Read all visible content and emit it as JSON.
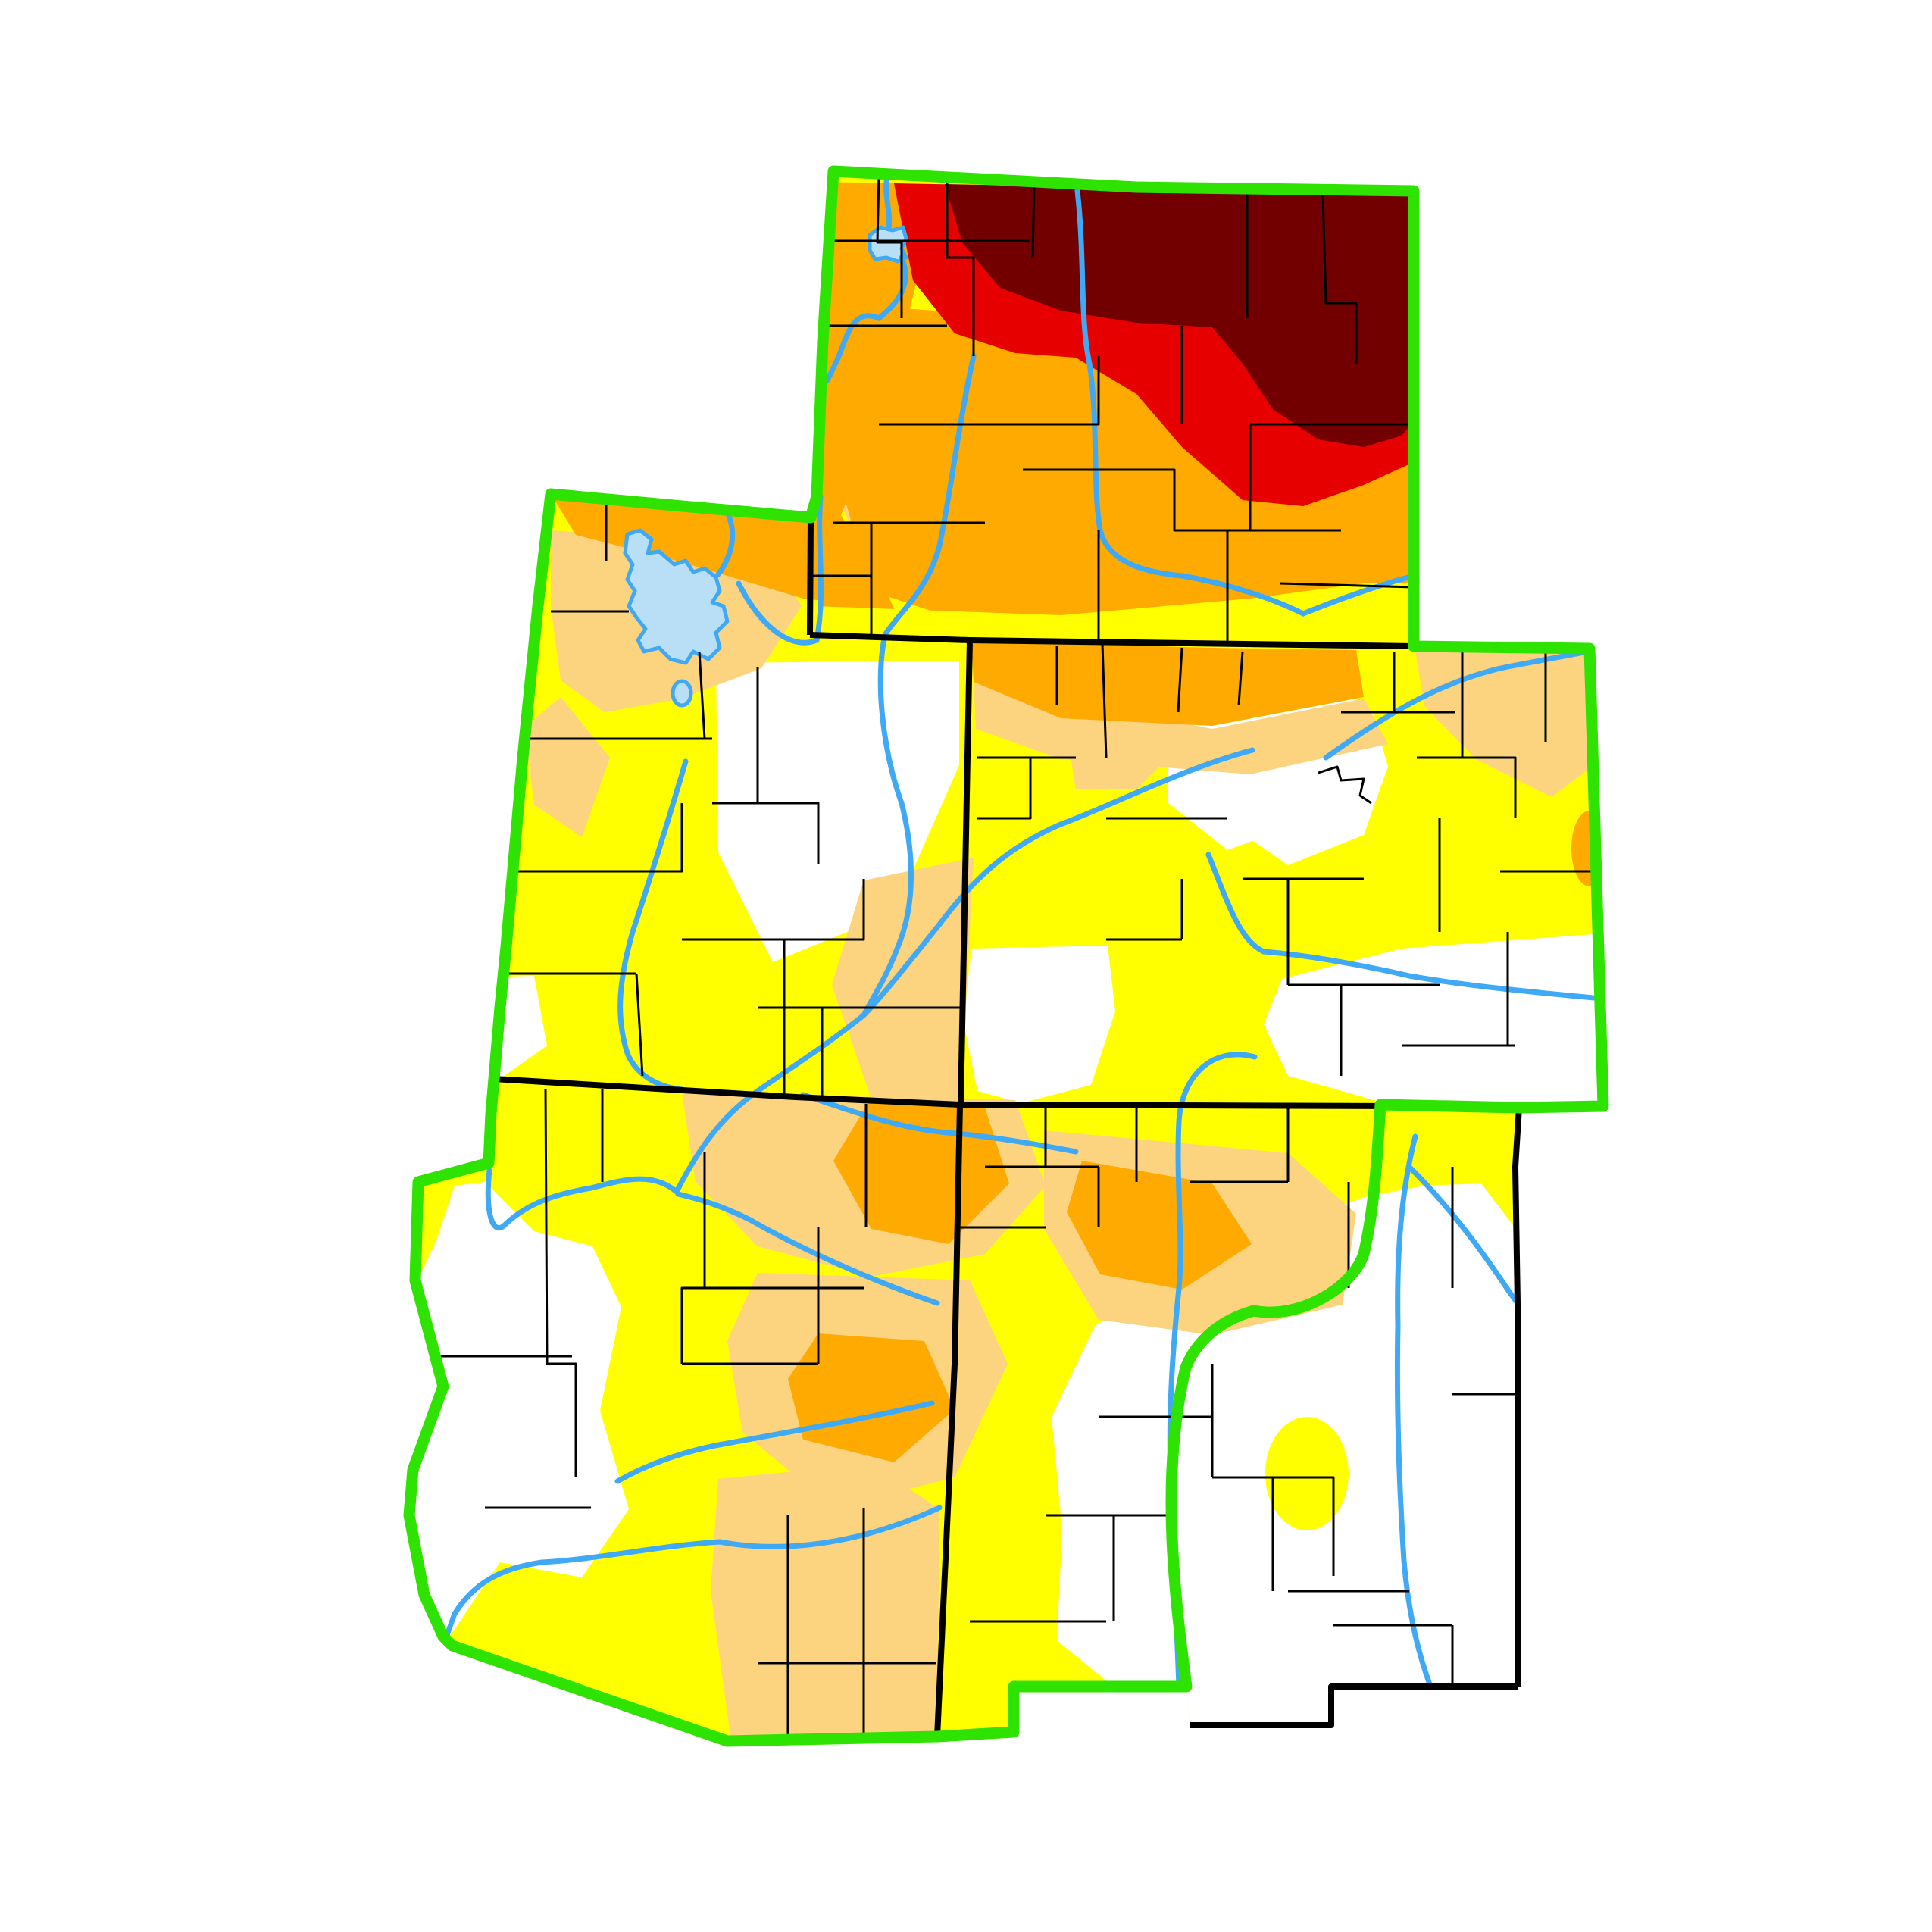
{
  "map": {
    "name": "intermountain-west-drought-map",
    "background": "#ffffff",
    "region_boundary_color": "#2fe300",
    "state_border_color": "#000000",
    "county_line_color": "#000000",
    "river_color": "#3fa9f5",
    "lake_fill": "#b8dff5",
    "lake_stroke": "#3fa9f5",
    "states": [
      {
        "name": "wyoming"
      },
      {
        "name": "utah"
      },
      {
        "name": "colorado"
      },
      {
        "name": "arizona"
      },
      {
        "name": "new-mexico"
      }
    ],
    "drought_levels": [
      {
        "name": "none",
        "color": "#ffffff"
      },
      {
        "name": "d0-abnormally-dry",
        "color": "#ffff00"
      },
      {
        "name": "d1-moderate-drought",
        "color": "#fcd37f"
      },
      {
        "name": "d2-severe-drought",
        "color": "#ffaa00"
      },
      {
        "name": "d3-extreme-drought",
        "color": "#e60000"
      },
      {
        "name": "d4-exceptional-drought",
        "color": "#730000"
      }
    ],
    "water_features": [
      {
        "name": "great-salt-lake"
      },
      {
        "name": "utah-lake"
      },
      {
        "name": "yellowstone-lake"
      },
      {
        "name": "snake-river"
      },
      {
        "name": "bighorn-river"
      },
      {
        "name": "green-river"
      },
      {
        "name": "bear-river"
      },
      {
        "name": "colorado-river"
      },
      {
        "name": "san-juan-river"
      },
      {
        "name": "little-colorado-river"
      },
      {
        "name": "salt-river"
      },
      {
        "name": "gila-river"
      },
      {
        "name": "south-platte-river"
      },
      {
        "name": "arkansas-river"
      },
      {
        "name": "rio-grande"
      },
      {
        "name": "pecos-river"
      },
      {
        "name": "canadian-river"
      },
      {
        "name": "sevier-river"
      }
    ]
  }
}
